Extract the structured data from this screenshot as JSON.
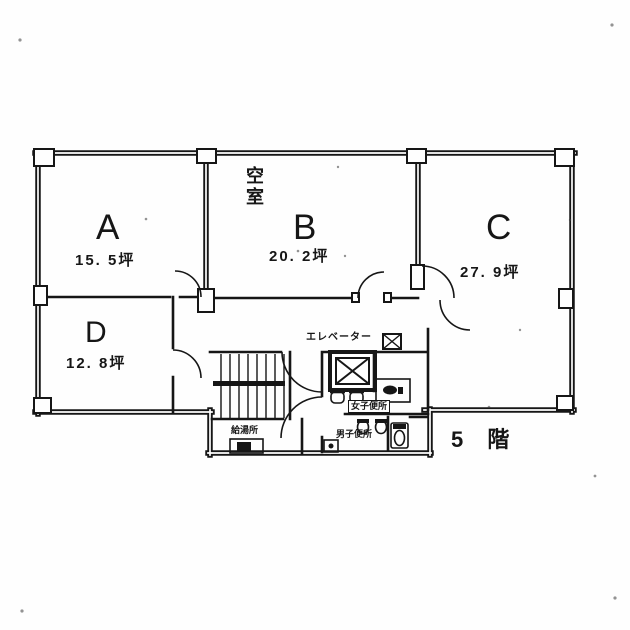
{
  "page": {
    "kind": "scanned office floor plan",
    "background": "#fefefe",
    "ink_color": "#161616"
  },
  "floor_label": "5 階",
  "rooms": [
    {
      "letter": "A",
      "area": "15. 5坪"
    },
    {
      "letter": "B",
      "area": "20. 2坪",
      "status": "空室"
    },
    {
      "letter": "C",
      "area": "27. 9坪"
    },
    {
      "letter": "D",
      "area": "12. 8坪"
    }
  ],
  "core": {
    "elevator_label": "エレベーター",
    "womens_toilet_label": "女子便所",
    "mens_toilet_label": "男子便所",
    "kitchenette_label": "給湯所"
  },
  "icons": {
    "elevator-x-icon": "square with X (elevator car)",
    "shaft-x-icon": "small square with X (duct/shaft)",
    "stairs-icon": "staircase with treads and center rail",
    "washbasin-icon": "two wash basins",
    "urinal-icon": "two urinals",
    "toilet-icon": "toilet in stall",
    "vanity-counter-icon": "counter with sink",
    "cleaning-sink-icon": "small slop sink",
    "kitchenette-sink-icon": "kitchenette sink unit",
    "door-arc-icon": "door swing arcs"
  }
}
